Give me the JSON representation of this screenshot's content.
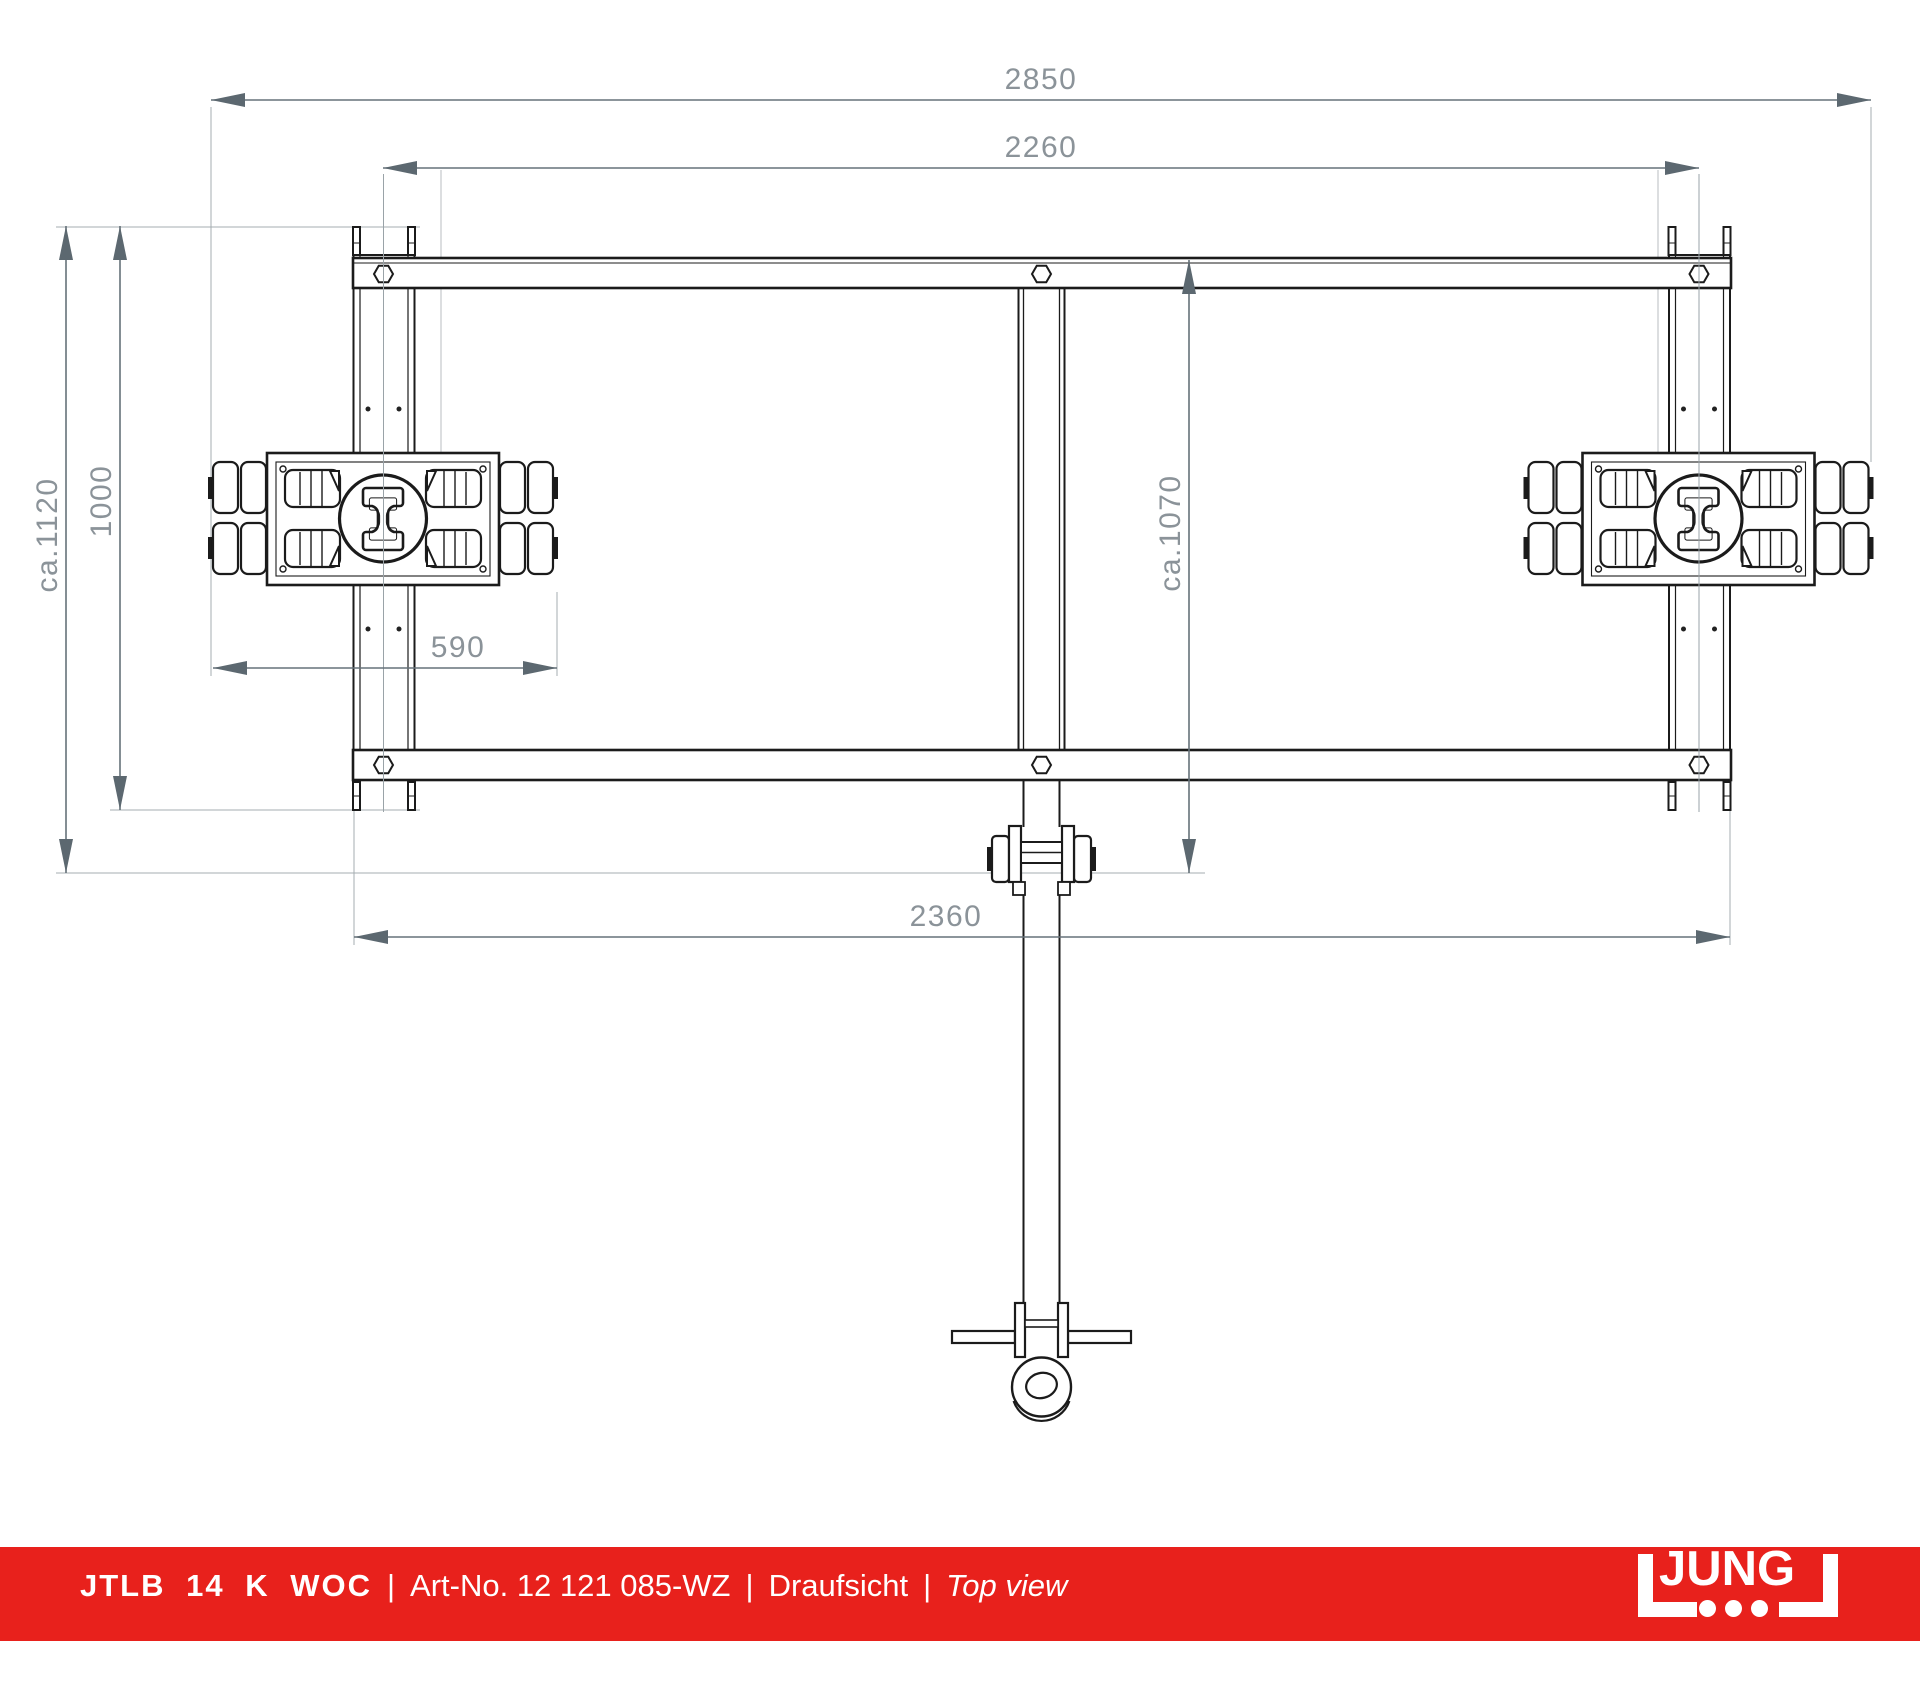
{
  "drawing": {
    "view": "top-view technical drawing of tandem transport trolley with drawbar",
    "dimensions": {
      "overall_length": "2850",
      "rail_spacing": "2260",
      "overall_width": "ca.1120",
      "rail_length": "1000",
      "drawbar_pivot": "ca.1070",
      "roller_unit_length": "590",
      "frame_length": "2360"
    },
    "colors": {
      "line": "#1b1b1b",
      "dimension_line": "#66727a",
      "dimension_arrow": "#5c6870",
      "dimension_text": "#8b9399",
      "extension_line": "#a4acb1",
      "centerline": "#9aa3a8"
    }
  },
  "footer": {
    "model": "JTLB 14 K WOC",
    "separator": "|",
    "art_no": "Art-No. 12 121 085-WZ",
    "view_label_de": "Draufsicht",
    "view_label_en": "Top view",
    "brand": {
      "logo_text": "JUNG",
      "bar_color": "#e8211c",
      "logo_color": "#ffffff"
    }
  }
}
